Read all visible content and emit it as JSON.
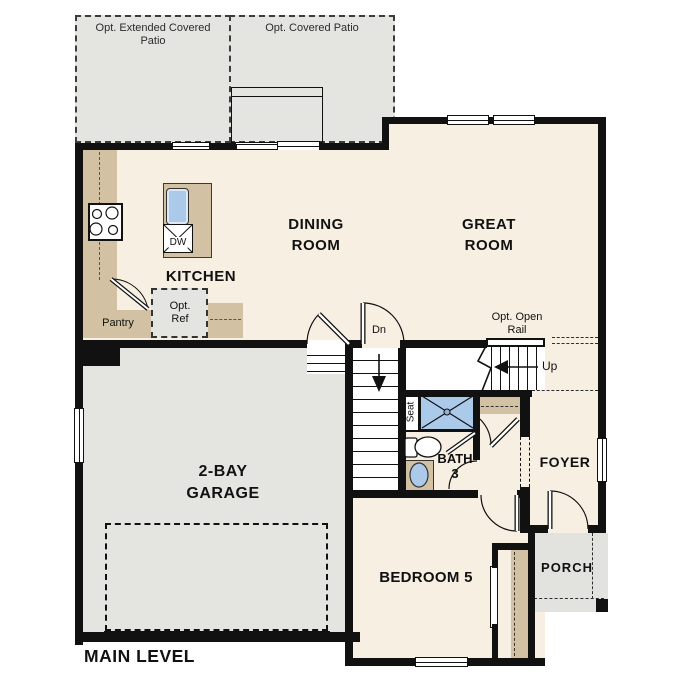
{
  "title": {
    "main_level": "MAIN LEVEL"
  },
  "rooms": {
    "extended_patio": "Opt. Extended Covered\nPatio",
    "covered_patio": "Opt. Covered Patio",
    "dining_room": "DINING\nROOM",
    "great_room": "GREAT\nROOM",
    "kitchen": "KITCHEN",
    "garage": "2-BAY\nGARAGE",
    "bedroom5": "BEDROOM 5",
    "bath3": "BATH\n3",
    "foyer": "FOYER",
    "porch": "PORCH"
  },
  "annotations": {
    "pantry": "Pantry",
    "opt_ref": "Opt.\nRef",
    "opt_open_rail": "Opt. Open\nRail",
    "stairs_down": "Dn",
    "stairs_up": "Up",
    "seat": "Seat",
    "dishwasher": "DW"
  },
  "colors": {
    "floor": "#f6efe2",
    "patio": "#e4e4e1",
    "porch": "#e2e2df",
    "counter": "#d2c1a3",
    "fixture_blue": "#abc9e9",
    "wall": "#111111"
  }
}
